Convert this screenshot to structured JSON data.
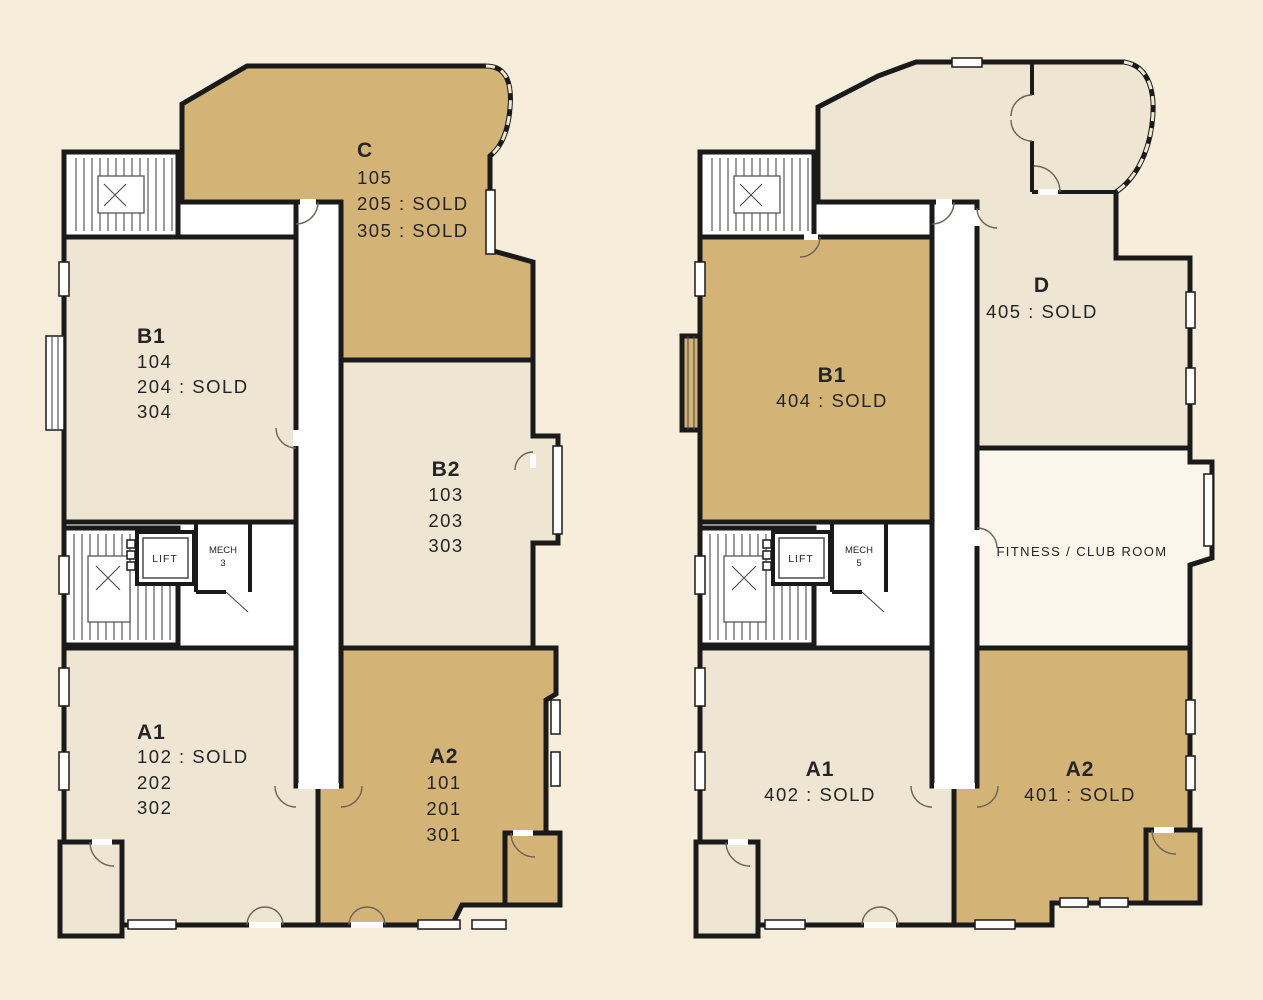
{
  "colors": {
    "background": "#f6edda",
    "tan": "#d3b476",
    "cream": "#eee6d2",
    "corridor_white": "#ffffff",
    "fitness_white": "#faf6ec",
    "wall": "#1a1a1a"
  },
  "left_plan": {
    "units": {
      "c": {
        "name": "C",
        "lines": [
          "105",
          "205 : SOLD",
          "305 : SOLD"
        ]
      },
      "b1": {
        "name": "B1",
        "lines": [
          "104",
          "204 : SOLD",
          "304"
        ]
      },
      "b2": {
        "name": "B2",
        "lines": [
          "103",
          "203",
          "303"
        ]
      },
      "a1": {
        "name": "A1",
        "lines": [
          "102 : SOLD",
          "202",
          "302"
        ]
      },
      "a2": {
        "name": "A2",
        "lines": [
          "101",
          "201",
          "301"
        ]
      }
    },
    "labels": {
      "lift": "LIFT",
      "mech": "MECH",
      "mech_number": "3"
    }
  },
  "right_plan": {
    "units": {
      "d": {
        "name": "D",
        "lines": [
          "405 : SOLD"
        ]
      },
      "b1": {
        "name": "B1",
        "lines": [
          "404 : SOLD"
        ]
      },
      "a1": {
        "name": "A1",
        "lines": [
          "402 : SOLD"
        ]
      },
      "a2": {
        "name": "A2",
        "lines": [
          "401 : SOLD"
        ]
      },
      "fitness": {
        "name": "FITNESS / CLUB ROOM"
      }
    },
    "labels": {
      "lift": "LIFT",
      "mech": "MECH",
      "mech_number": "5"
    }
  }
}
